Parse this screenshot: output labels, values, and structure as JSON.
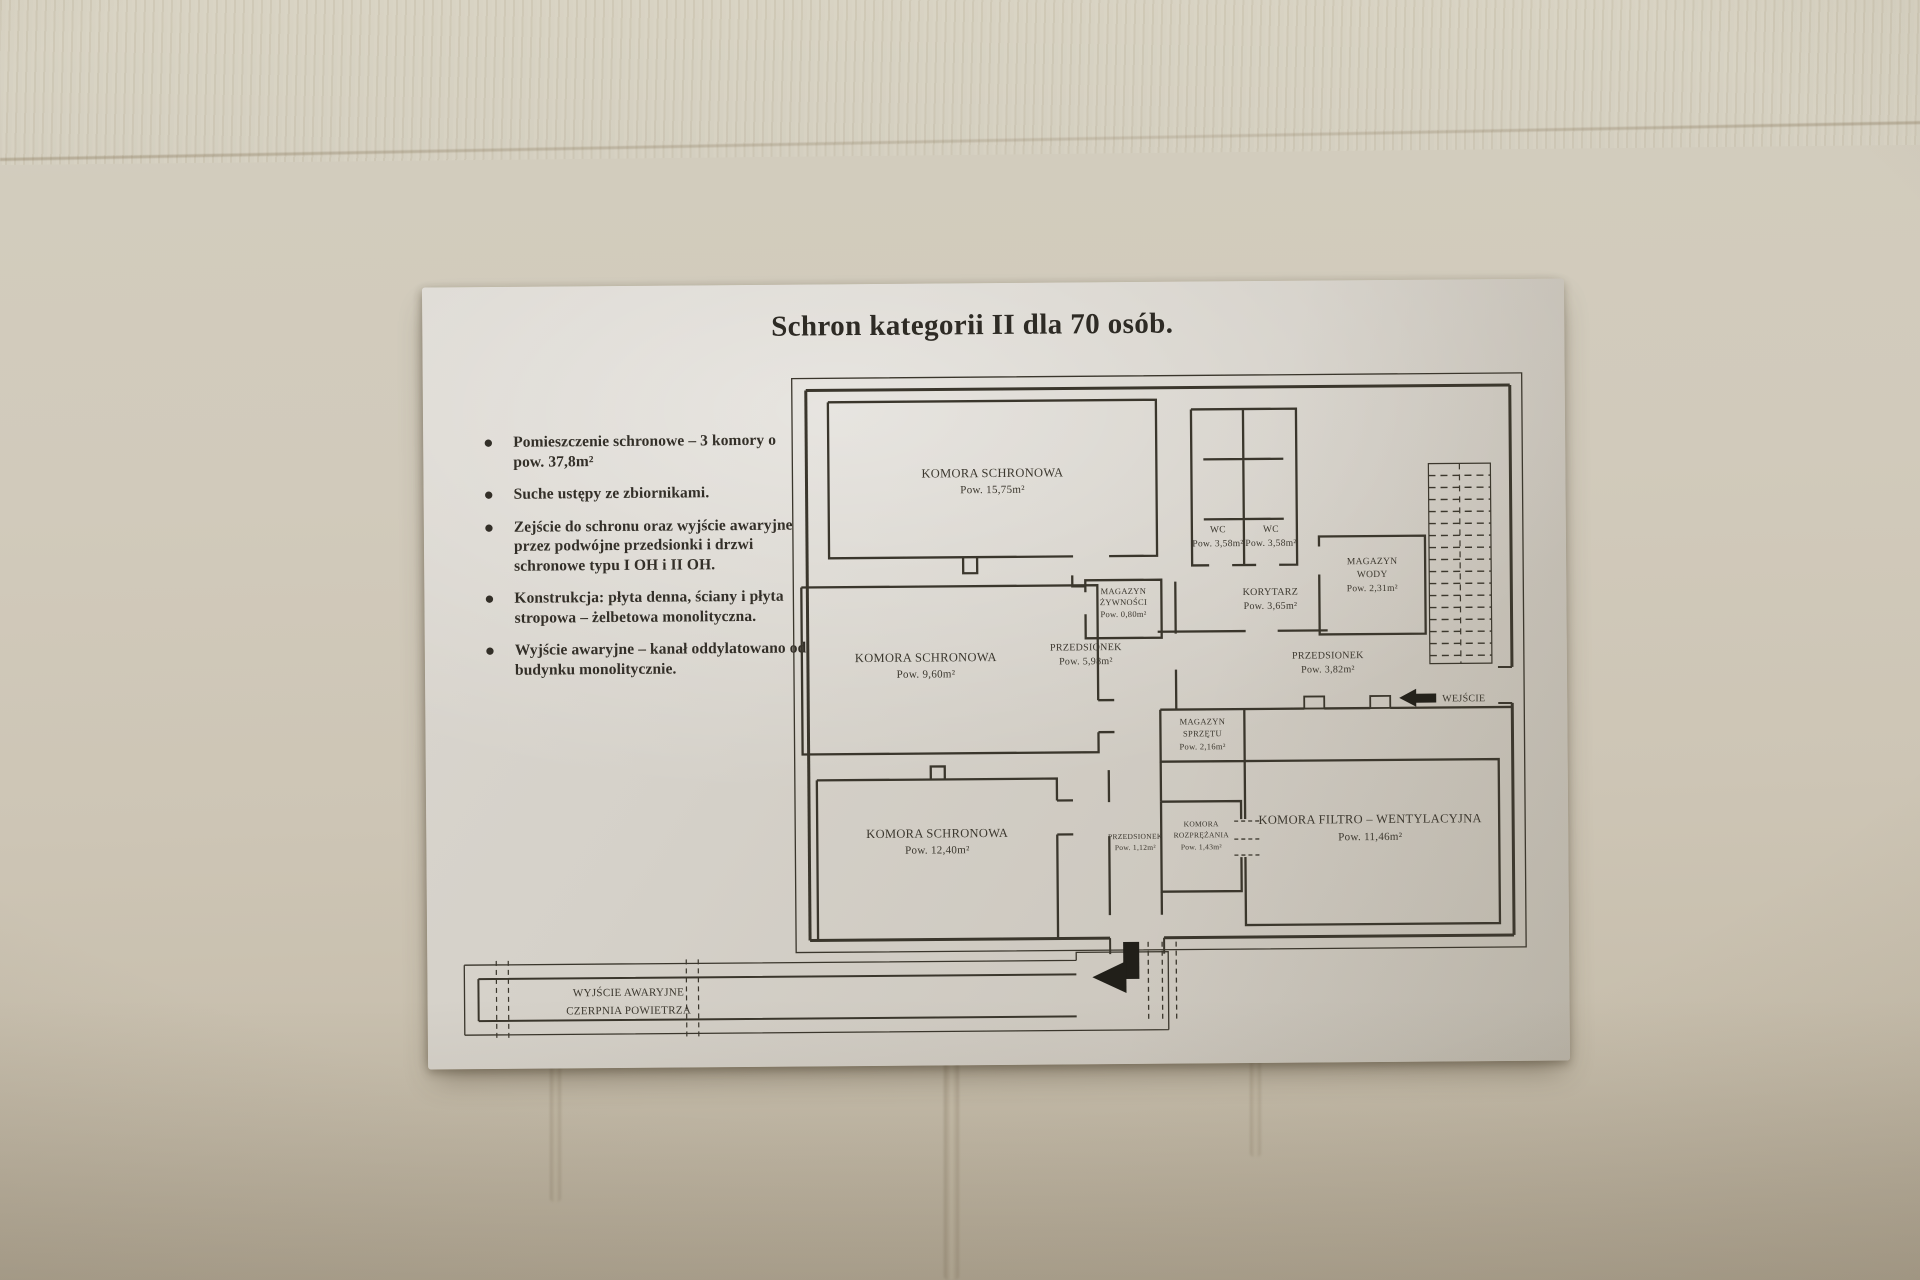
{
  "colors": {
    "paper": "#d5d1c9",
    "ink": "#3a362c",
    "wall": "#d0cabb",
    "arrow": "#211f19"
  },
  "poster": {
    "title": "Schron kategorii II dla 70 osób.",
    "bullets": [
      "Pomieszczenie schronowe – 3 komory o pow. 37,8m²",
      "Suche ustępy ze zbiornikami.",
      "Zejście do schronu oraz wyjście awaryjne przez podwójne przedsionki i drzwi schronowe typu I OH i II OH.",
      "Konstrukcja: płyta denna, ściany i płyta stropowa – żelbetowa monolityczna.",
      "Wyjście awaryjne – kanał oddylatowano od budynku monolitycznie."
    ]
  },
  "plan": {
    "rooms": [
      {
        "name": "KOMORA SCHRONOWA",
        "area": "Pow. 15,75m²"
      },
      {
        "name": "KOMORA SCHRONOWA",
        "area": "Pow. 9,60m²"
      },
      {
        "name": "KOMORA SCHRONOWA",
        "area": "Pow. 12,40m²"
      },
      {
        "name": "PRZEDSIONEK",
        "area": "Pow. 5,98m²"
      },
      {
        "name": "MAGAZYN",
        "name2": "ŻYWNOŚCI",
        "area": "Pow. 0,80m²"
      },
      {
        "name": "WC",
        "area": "Pow. 3,58m²"
      },
      {
        "name": "WC",
        "area": "Pow. 3,58m²"
      },
      {
        "name": "KORYTARZ",
        "area": "Pow. 3,65m²"
      },
      {
        "name": "MAGAZYN",
        "name2": "WODY",
        "area": "Pow. 2,31m²"
      },
      {
        "name": "PRZEDSIONEK",
        "area": "Pow. 3,82m²"
      },
      {
        "name": "MAGAZYN",
        "name2": "SPRZĘTU",
        "area": "Pow. 2,16m²"
      },
      {
        "name": "PRZEDSIONEK",
        "area": "Pow. 1,12m²"
      },
      {
        "name": "KOMORA",
        "name2": "ROZPRĘŻANIA",
        "area": "Pow. 1,43m²"
      },
      {
        "name": "KOMORA FILTRO – WENTYLACYJNA",
        "area": "Pow. 11,46m²"
      }
    ],
    "entrance_label": "WEJŚCIE",
    "emergency_exit_label_line1": "WYJŚCIE AWARYJNE",
    "emergency_exit_label_line2": "CZERPNIA POWIETRZA"
  }
}
